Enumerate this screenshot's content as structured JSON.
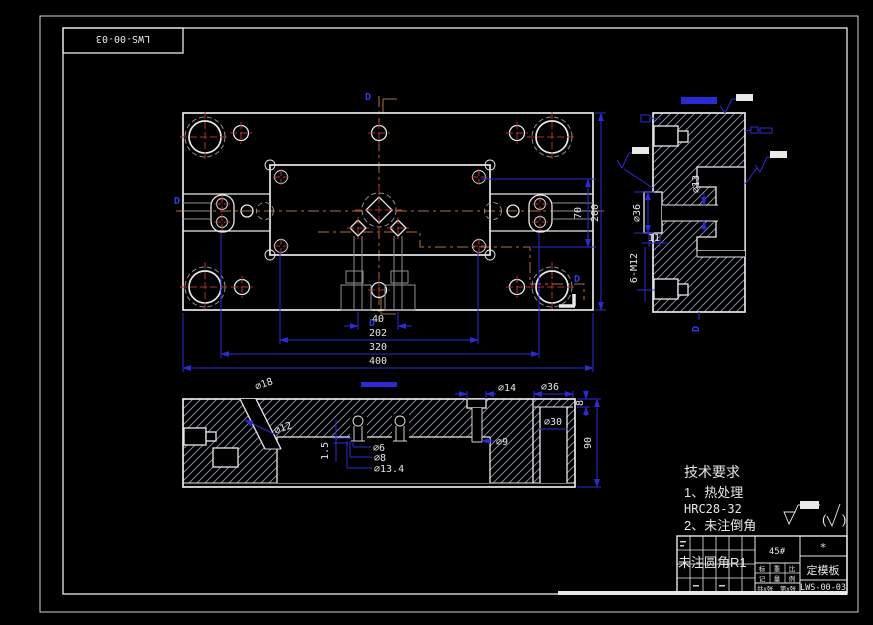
{
  "frame": {
    "corner_label": "LWS-00-03"
  },
  "markers": {
    "section": "D"
  },
  "top_view": {
    "dims": {
      "w40": "40",
      "w202": "202",
      "w320": "320",
      "w400": "400",
      "h70": "70",
      "h200": "200"
    }
  },
  "side_view": {
    "dims": {
      "d13": "⌀13",
      "d36": "⌀36",
      "len11": "11",
      "thread": "6-M12"
    }
  },
  "section_view": {
    "dims": {
      "d18": "⌀18",
      "d12": "⌀12",
      "step": "1.5",
      "d6": "⌀6",
      "d8": "⌀8",
      "d13_4": "⌀13.4",
      "d14": "⌀14",
      "d36": "⌀36",
      "d9": "⌀9",
      "d30": "⌀30",
      "t8": "8",
      "h90": "90"
    }
  },
  "tech_requirements": {
    "title": "技术要求",
    "line1": "1、热处理",
    "line2": "HRC28-32",
    "line3": "2、未注倒角",
    "line4": "未注圆角R1"
  },
  "surface_note": {
    "open": "(",
    "close": ")"
  },
  "title_block": {
    "material": "45#",
    "mark": "*",
    "part_name": "定模板",
    "drawing_no": "LWS-00-03",
    "labels": {
      "c1a": "标",
      "c1b": "记",
      "c2a": "重",
      "c2b": "量",
      "c3a": "比",
      "c3b": "例"
    },
    "sheets": {
      "total": "共x张",
      "current": "第x张"
    }
  },
  "colors": {
    "background": "#000000",
    "line": "#e9e9e9",
    "dimension": "#2b2bd6",
    "centerline": "#b4713c",
    "center_mark": "#b23030",
    "hidden": "#8f8f8f",
    "hatch": "#8d97ad"
  }
}
